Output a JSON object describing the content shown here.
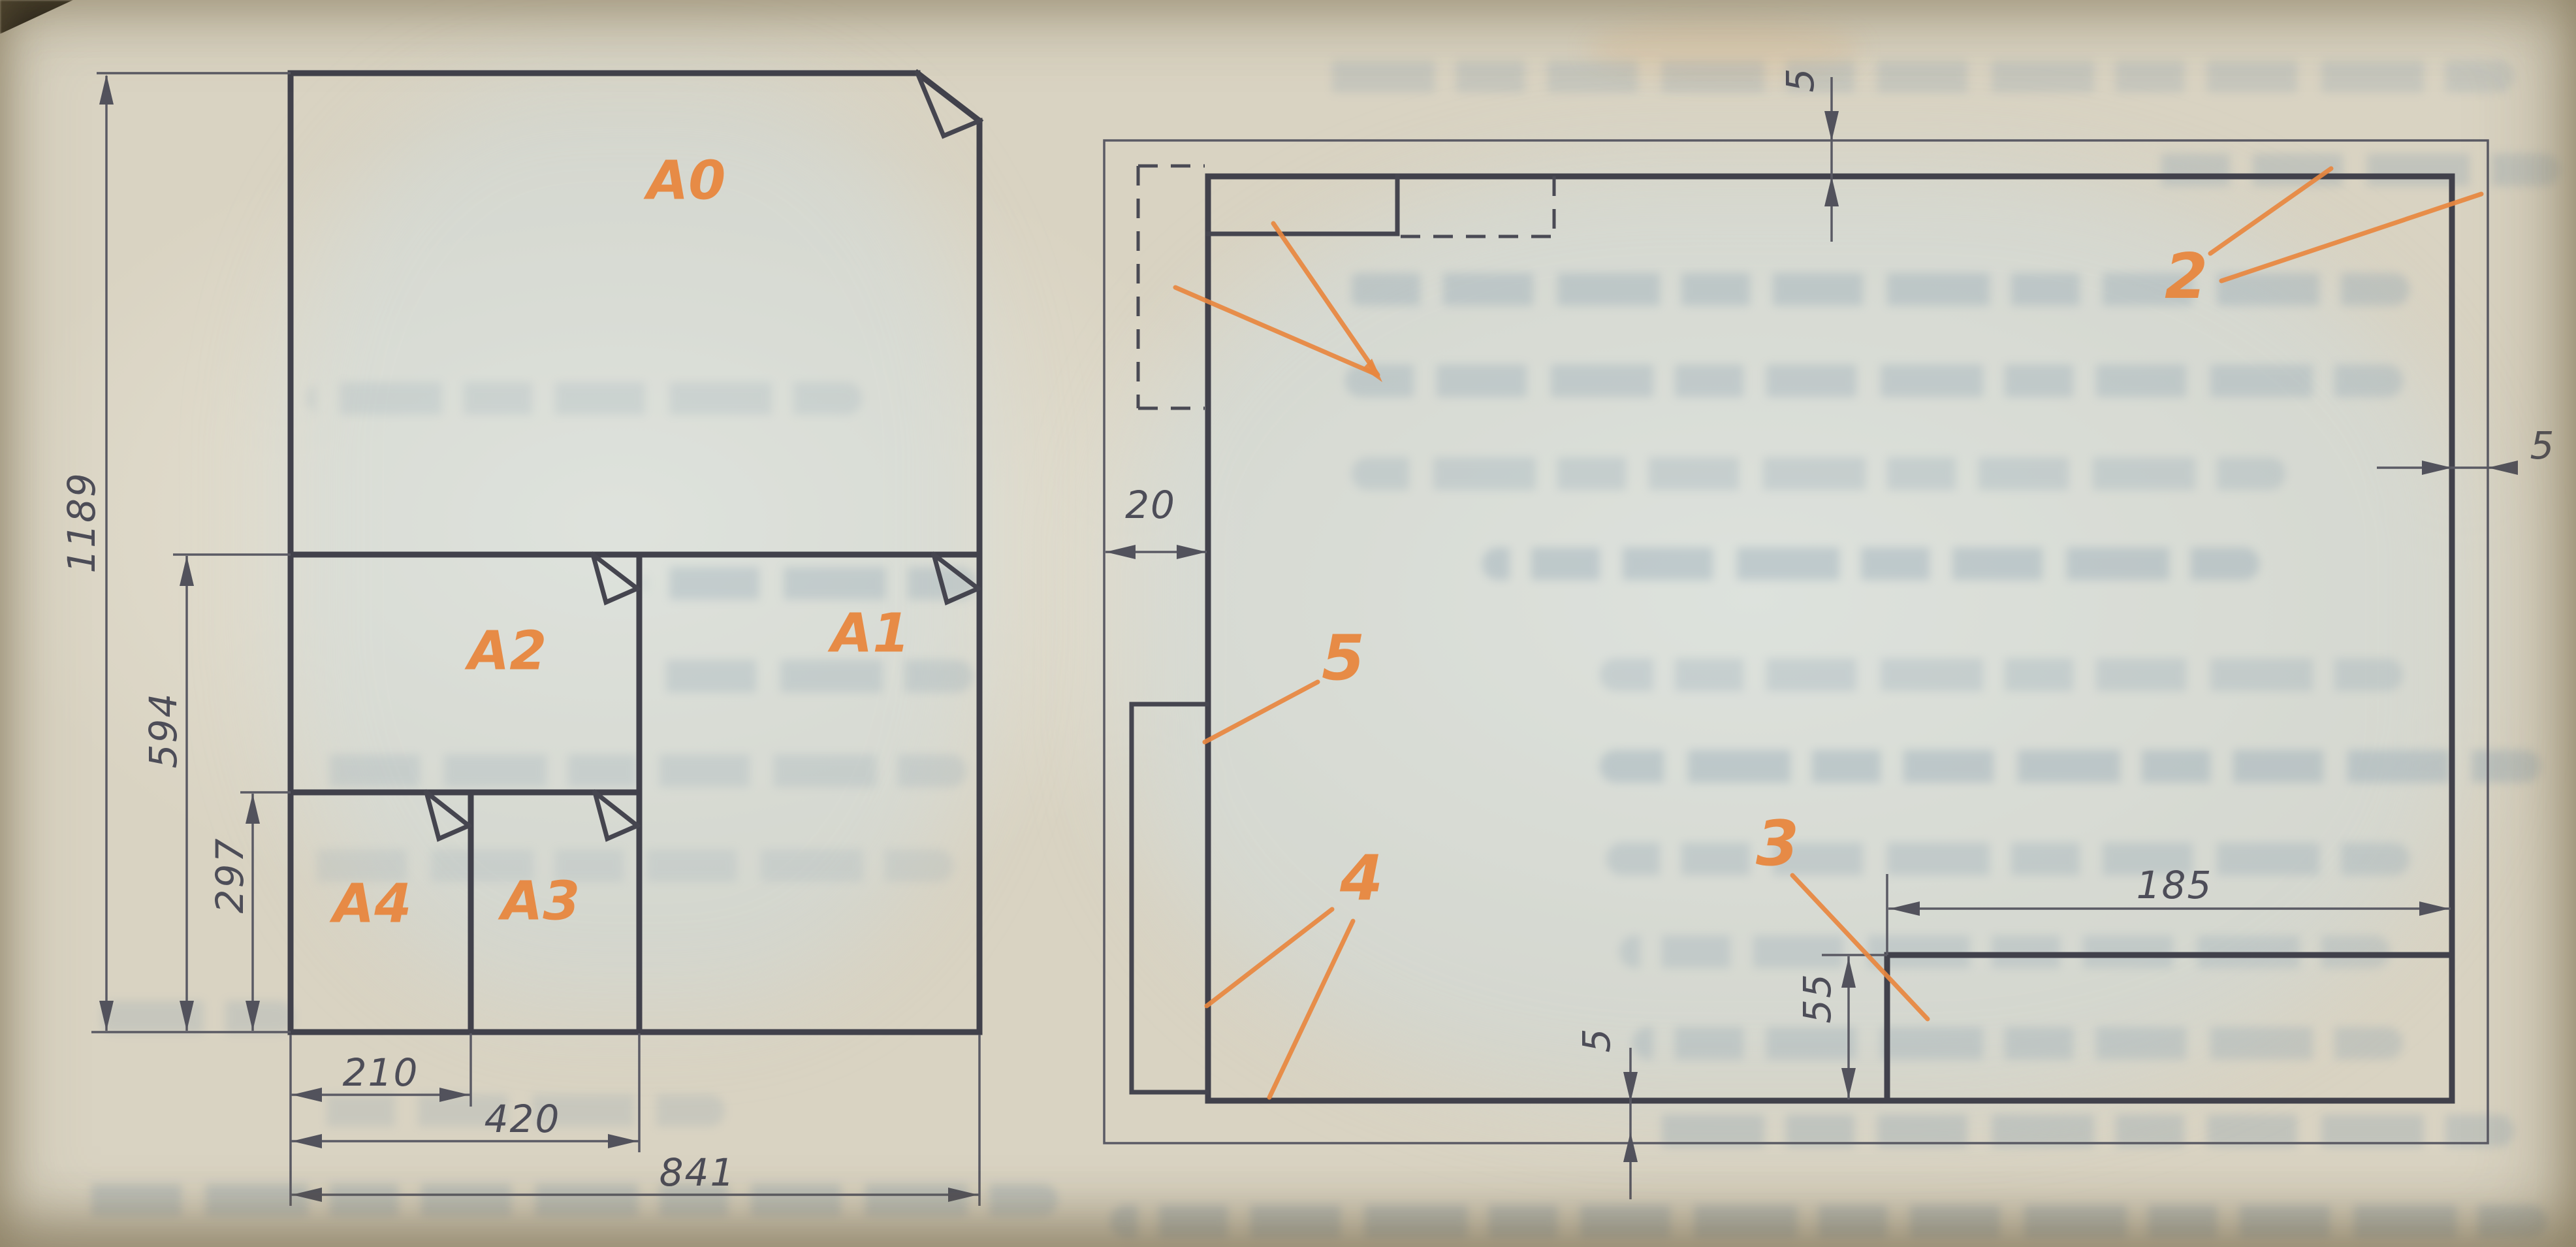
{
  "figure": {
    "type": "technical-drawing-book-figure",
    "accent_color": "#e8873f",
    "line_color": "#45454f"
  },
  "formats": {
    "a0": "A0",
    "a1": "A1",
    "a2": "A2",
    "a3": "A3",
    "a4": "A4",
    "dim_height_a0": "1189",
    "dim_height_a1": "594",
    "dim_height_a4": "297",
    "dim_width_a4": "210",
    "dim_width_a2": "420",
    "dim_width_a0": "841"
  },
  "sheet_layout": {
    "dim_margin_top": "5",
    "dim_margin_right": "5",
    "dim_margin_left": "20",
    "dim_margin_bottom": "5",
    "dim_title_block_width": "185",
    "dim_title_block_height": "55",
    "callout_frame": "2",
    "callout_title_block": "3",
    "callout_frame_lines": "4",
    "callout_side_column": "5"
  }
}
